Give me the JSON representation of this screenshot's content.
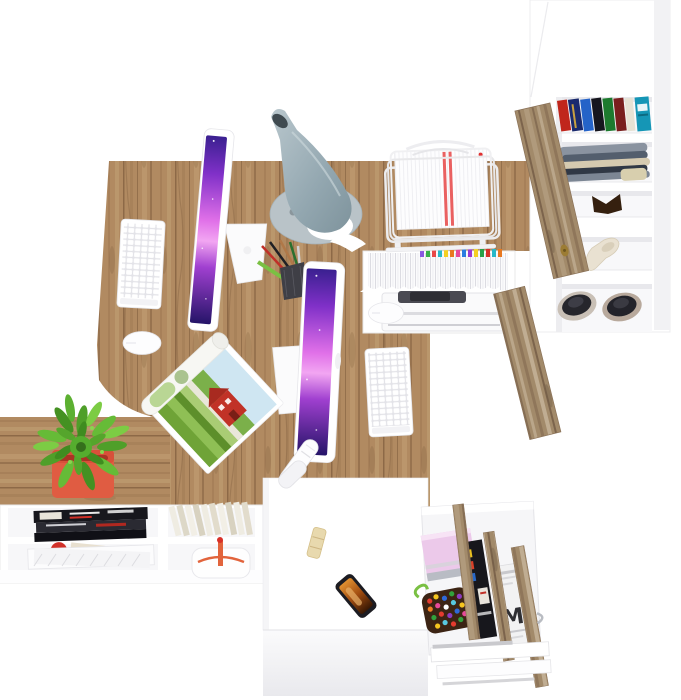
{
  "scene": {
    "type": "3d-furniture-render",
    "description": "Top-down view of a white-and-oak home office set: L-shaped double desk with two all-in-one computers, desk lamp, wire document tray, tall open wardrobe with wood doors, low sideboard with plant, and a pedestal cabinet with an open accessory drawer",
    "background": "#ffffff",
    "newspaper_letter": "M",
    "palette": {
      "wood": "#b18a61",
      "wood_grain": "#8d6947",
      "door_wood": "#a28a6a",
      "furniture_white": "#ffffff",
      "lamp_gray": "#9fb2bb",
      "screen_purple": "#8030c8",
      "screen_magenta": "#e070e8",
      "plant_green": "#55ad2e",
      "pot_red": "#d8503a",
      "bag_orange": "#e2643c",
      "teal_box": "#1596b6",
      "pink_box": "#ecc9ea",
      "phone_frame": "#1c1c22",
      "candy_bag": "#3c2414",
      "brass_handle": "#9c7c34"
    },
    "objects": [
      {
        "id": "desk",
        "label": "L-shaped oak desk for two workstations"
      },
      {
        "id": "monitor-1",
        "label": "all-in-one computer, workstation 1"
      },
      {
        "id": "keyboard-1",
        "label": "white keyboard, workstation 1"
      },
      {
        "id": "mouse-1",
        "label": "white mouse, workstation 1"
      },
      {
        "id": "monitor-2",
        "label": "all-in-one computer, workstation 2"
      },
      {
        "id": "keyboard-2",
        "label": "white keyboard, workstation 2"
      },
      {
        "id": "mouse-2",
        "label": "white mouse, workstation 2"
      },
      {
        "id": "desk-lamp",
        "label": "gray cone desk lamp"
      },
      {
        "id": "pencil-cup",
        "label": "mesh cup with pens and pencils"
      },
      {
        "id": "open-magazine",
        "label": "open magazine with farm photo"
      },
      {
        "id": "stapler",
        "label": "white stapler"
      },
      {
        "id": "paper-tray",
        "label": "wire document tray with papers"
      },
      {
        "id": "document-shelf",
        "label": "shelf stacked with tabbed documents"
      },
      {
        "id": "printer",
        "label": "printer under return desk"
      },
      {
        "id": "wardrobe",
        "label": "tall white cabinet with open wood doors"
      },
      {
        "id": "books",
        "label": "row of colored books"
      },
      {
        "id": "folded-clothes",
        "label": "folded clothes"
      },
      {
        "id": "heel-shoe",
        "label": "beige heeled shoe"
      },
      {
        "id": "sneakers",
        "label": "pair of dark sneakers"
      },
      {
        "id": "plant",
        "label": "succulent in red pot"
      },
      {
        "id": "sideboard",
        "label": "low white sideboard with magazines, books and bag"
      },
      {
        "id": "pedestal-cabinet",
        "label": "white pedestal cabinet"
      },
      {
        "id": "smartphone",
        "label": "smartphone on cabinet"
      },
      {
        "id": "open-drawer",
        "label": "open drawer with wood dividers, gift box, candy and newspapers"
      }
    ]
  }
}
